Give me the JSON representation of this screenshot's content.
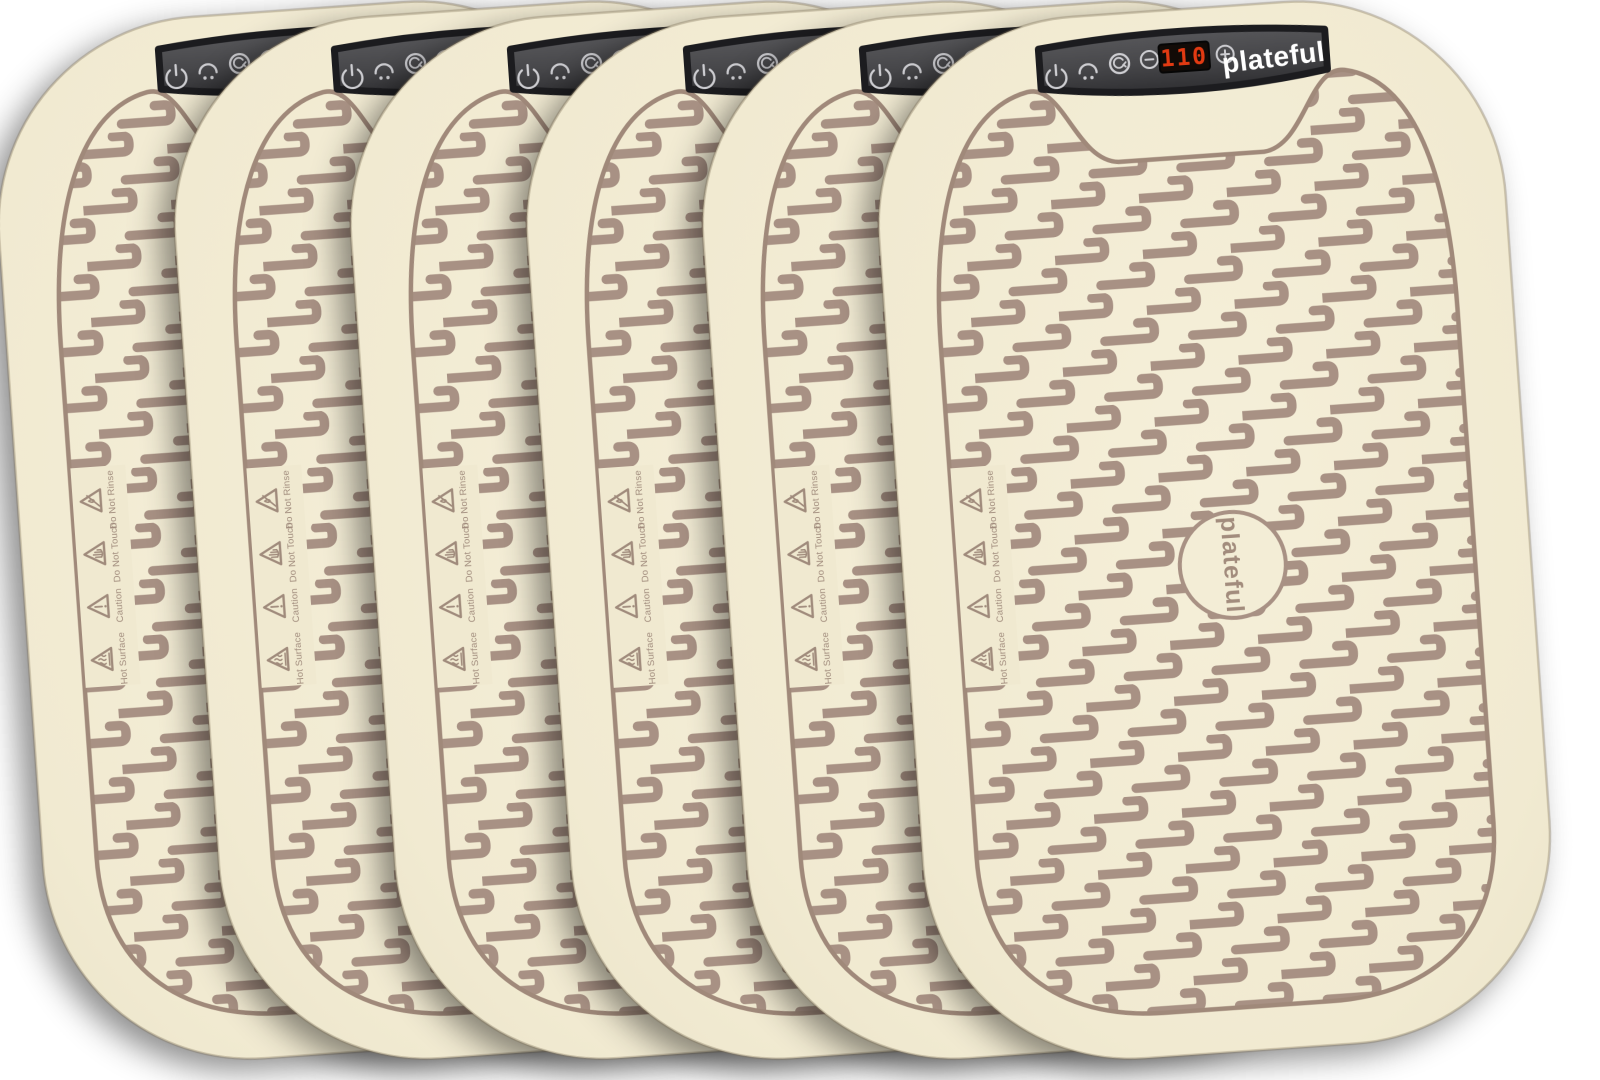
{
  "product": {
    "brand": "plateful",
    "item": "silicone warming mat",
    "mat_count": 6
  },
  "panel": {
    "display_value": "110",
    "wordmark": "plateful",
    "icons": [
      "power-icon",
      "keep-warm-icon",
      "timer-icon",
      "minus-icon",
      "temperature-display",
      "plus-icon"
    ]
  },
  "logo": {
    "text": "plateful"
  },
  "warnings": [
    {
      "label": "Do Not Rinse"
    },
    {
      "label": "Do Not Touch"
    },
    {
      "label": "Caution"
    },
    {
      "label": "Hot Surface"
    }
  ],
  "colors": {
    "mat_cream": "#f1ead1",
    "pattern_taupe": "#a89184",
    "pattern_outline": "#a0897a",
    "panel_dark": "#424245",
    "panel_border": "#1c1c1f",
    "led_red": "#e23a12",
    "led_background": "#120b07",
    "icon_gray": "#cdcdd1",
    "wordmark_white": "#ffffff"
  }
}
